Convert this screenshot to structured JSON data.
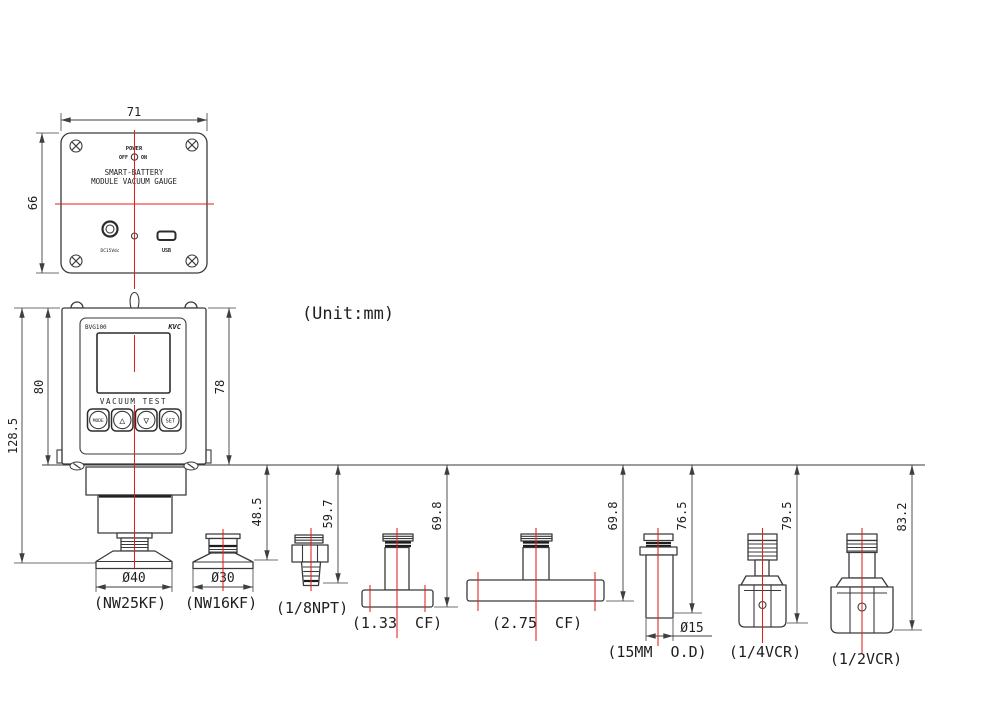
{
  "drawing": {
    "unit_note": "(Unit:mm)"
  },
  "back_view": {
    "dim_width": "71",
    "dim_height": "66",
    "power_label": "POWER",
    "off_label": "OFF",
    "on_label": "ON",
    "title_line1": "SMART-BATTERY",
    "title_line2": "MODULE VACUUM GAUGE",
    "dc_jack_label": "DC15Vdc",
    "usb_label": "USB"
  },
  "front_view": {
    "dim_total_height": "128.5",
    "dim_body_height": "80",
    "dim_panel_height": "78",
    "model_label": "BVG100",
    "brand_label": "KVC",
    "screen_caption": "VACUUM TEST",
    "button_mode": "MODE",
    "button_up": "△",
    "button_down": "▽",
    "button_set": "SET"
  },
  "fittings": {
    "nw25kf": {
      "label": "(NW25KF)",
      "height": "48.5",
      "diameter": "Ø40"
    },
    "nw16kf": {
      "label": "(NW16KF)",
      "diameter": "Ø30"
    },
    "npt18": {
      "label": "(1/8NPT)",
      "height": "59.7"
    },
    "cf133": {
      "label": "(1.33  CF)",
      "height": "69.8"
    },
    "cf275": {
      "label": "(2.75  CF)",
      "height": "69.8"
    },
    "od15mm": {
      "label": "(15MM  O.D)",
      "height": "76.5",
      "diameter": "Ø15"
    },
    "vcr14": {
      "label": "(1/4VCR)",
      "height": "79.5"
    },
    "vcr12": {
      "label": "(1/2VCR)",
      "height": "83.2"
    }
  },
  "colors": {
    "line": "#3a3a3a",
    "centerline_red": "#e0201c"
  }
}
